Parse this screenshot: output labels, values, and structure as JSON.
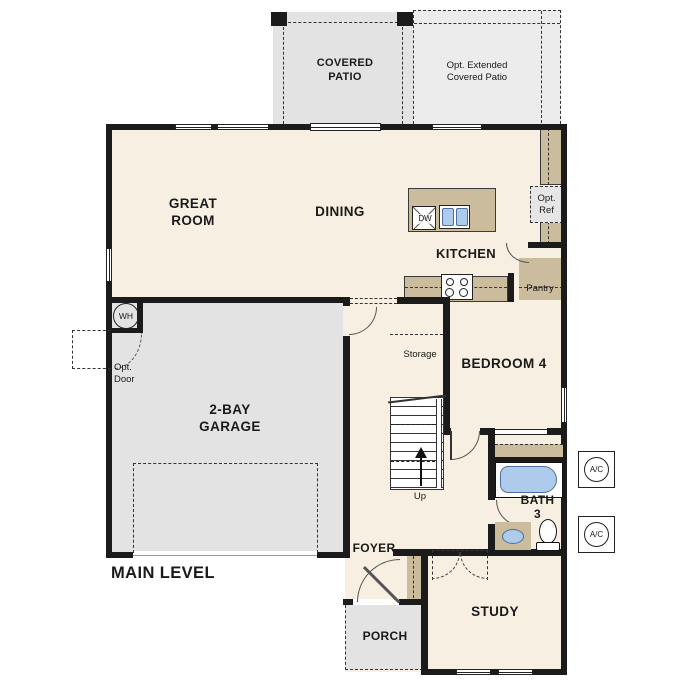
{
  "plan": {
    "title": "MAIN LEVEL",
    "rooms": {
      "covered_patio": "COVERED\nPATIO",
      "opt_extended_patio": "Opt. Extended\nCovered Patio",
      "great_room": "GREAT\nROOM",
      "dining": "DINING",
      "kitchen": "KITCHEN",
      "garage": "2-BAY\nGARAGE",
      "bedroom4": "BEDROOM 4",
      "bath3": "BATH\n3",
      "study": "STUDY",
      "foyer": "FOYER",
      "porch": "PORCH",
      "storage": "Storage",
      "pantry": "Pantry"
    },
    "annotations": {
      "up": "Up",
      "wh": "WH",
      "ac": "A/C",
      "dw": "DW",
      "opt_ref": "Opt.\nRef",
      "opt_door": "Opt.\nDoor"
    },
    "colors": {
      "wall": "#1b1b1b",
      "floor": "#f7f0e2",
      "garage_gray": "#e3e3e3",
      "patio_gray": "#ececec",
      "counter_tan": "#cbbc9e",
      "fixture_blue": "#aecbec",
      "fixture_blue_border": "#4a6fa0"
    }
  }
}
